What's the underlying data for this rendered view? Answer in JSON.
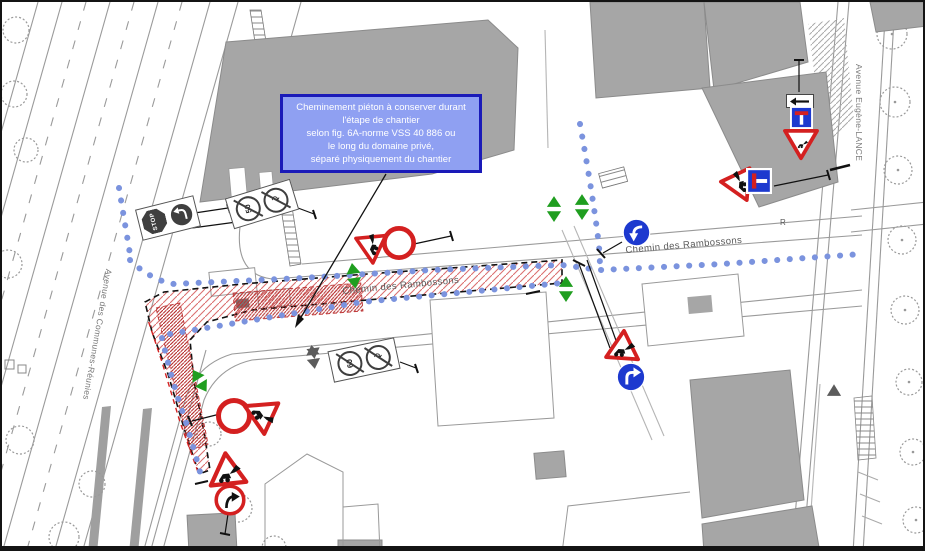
{
  "annotation": {
    "lines": [
      "Cheminement piéton à conserver durant",
      "l'étape de chantier",
      "selon fig. 6A-norme VSS 40 886 ou",
      "le long du domaine privé,",
      "séparé physiquement du chantier"
    ]
  },
  "streets": {
    "rambossons": "Chemin des Rambossons",
    "communes_reunies": "Avenue des Communes-Réunies",
    "eugene_lance": "Avenue Eugène-LANCE"
  },
  "signs": {
    "stop_label": "STOP",
    "removed_speed_1": "50",
    "removed_speed_2": "60",
    "glyph_names": [
      "roadworks-triangle",
      "no-entry-circle",
      "mandatory-direction-blue",
      "dead-end-blue",
      "yield-triangle",
      "stop-octagon",
      "direction-arrow-plate",
      "removed-sign-slash",
      "pedestrian-path-dots",
      "work-zone-hatch"
    ]
  },
  "misc": {
    "curb_mark": "R"
  },
  "colors": {
    "pedestrian_path": "#7b93de",
    "work_zone_hatch": "#cf4040",
    "sign_red": "#d42020",
    "sign_blue": "#1d39cf",
    "arrow_green": "#1f9e1f",
    "building_gray": "#a6a6a6",
    "annotation_bg": "#8fa0f2",
    "annotation_border": "#1a1ab8"
  }
}
